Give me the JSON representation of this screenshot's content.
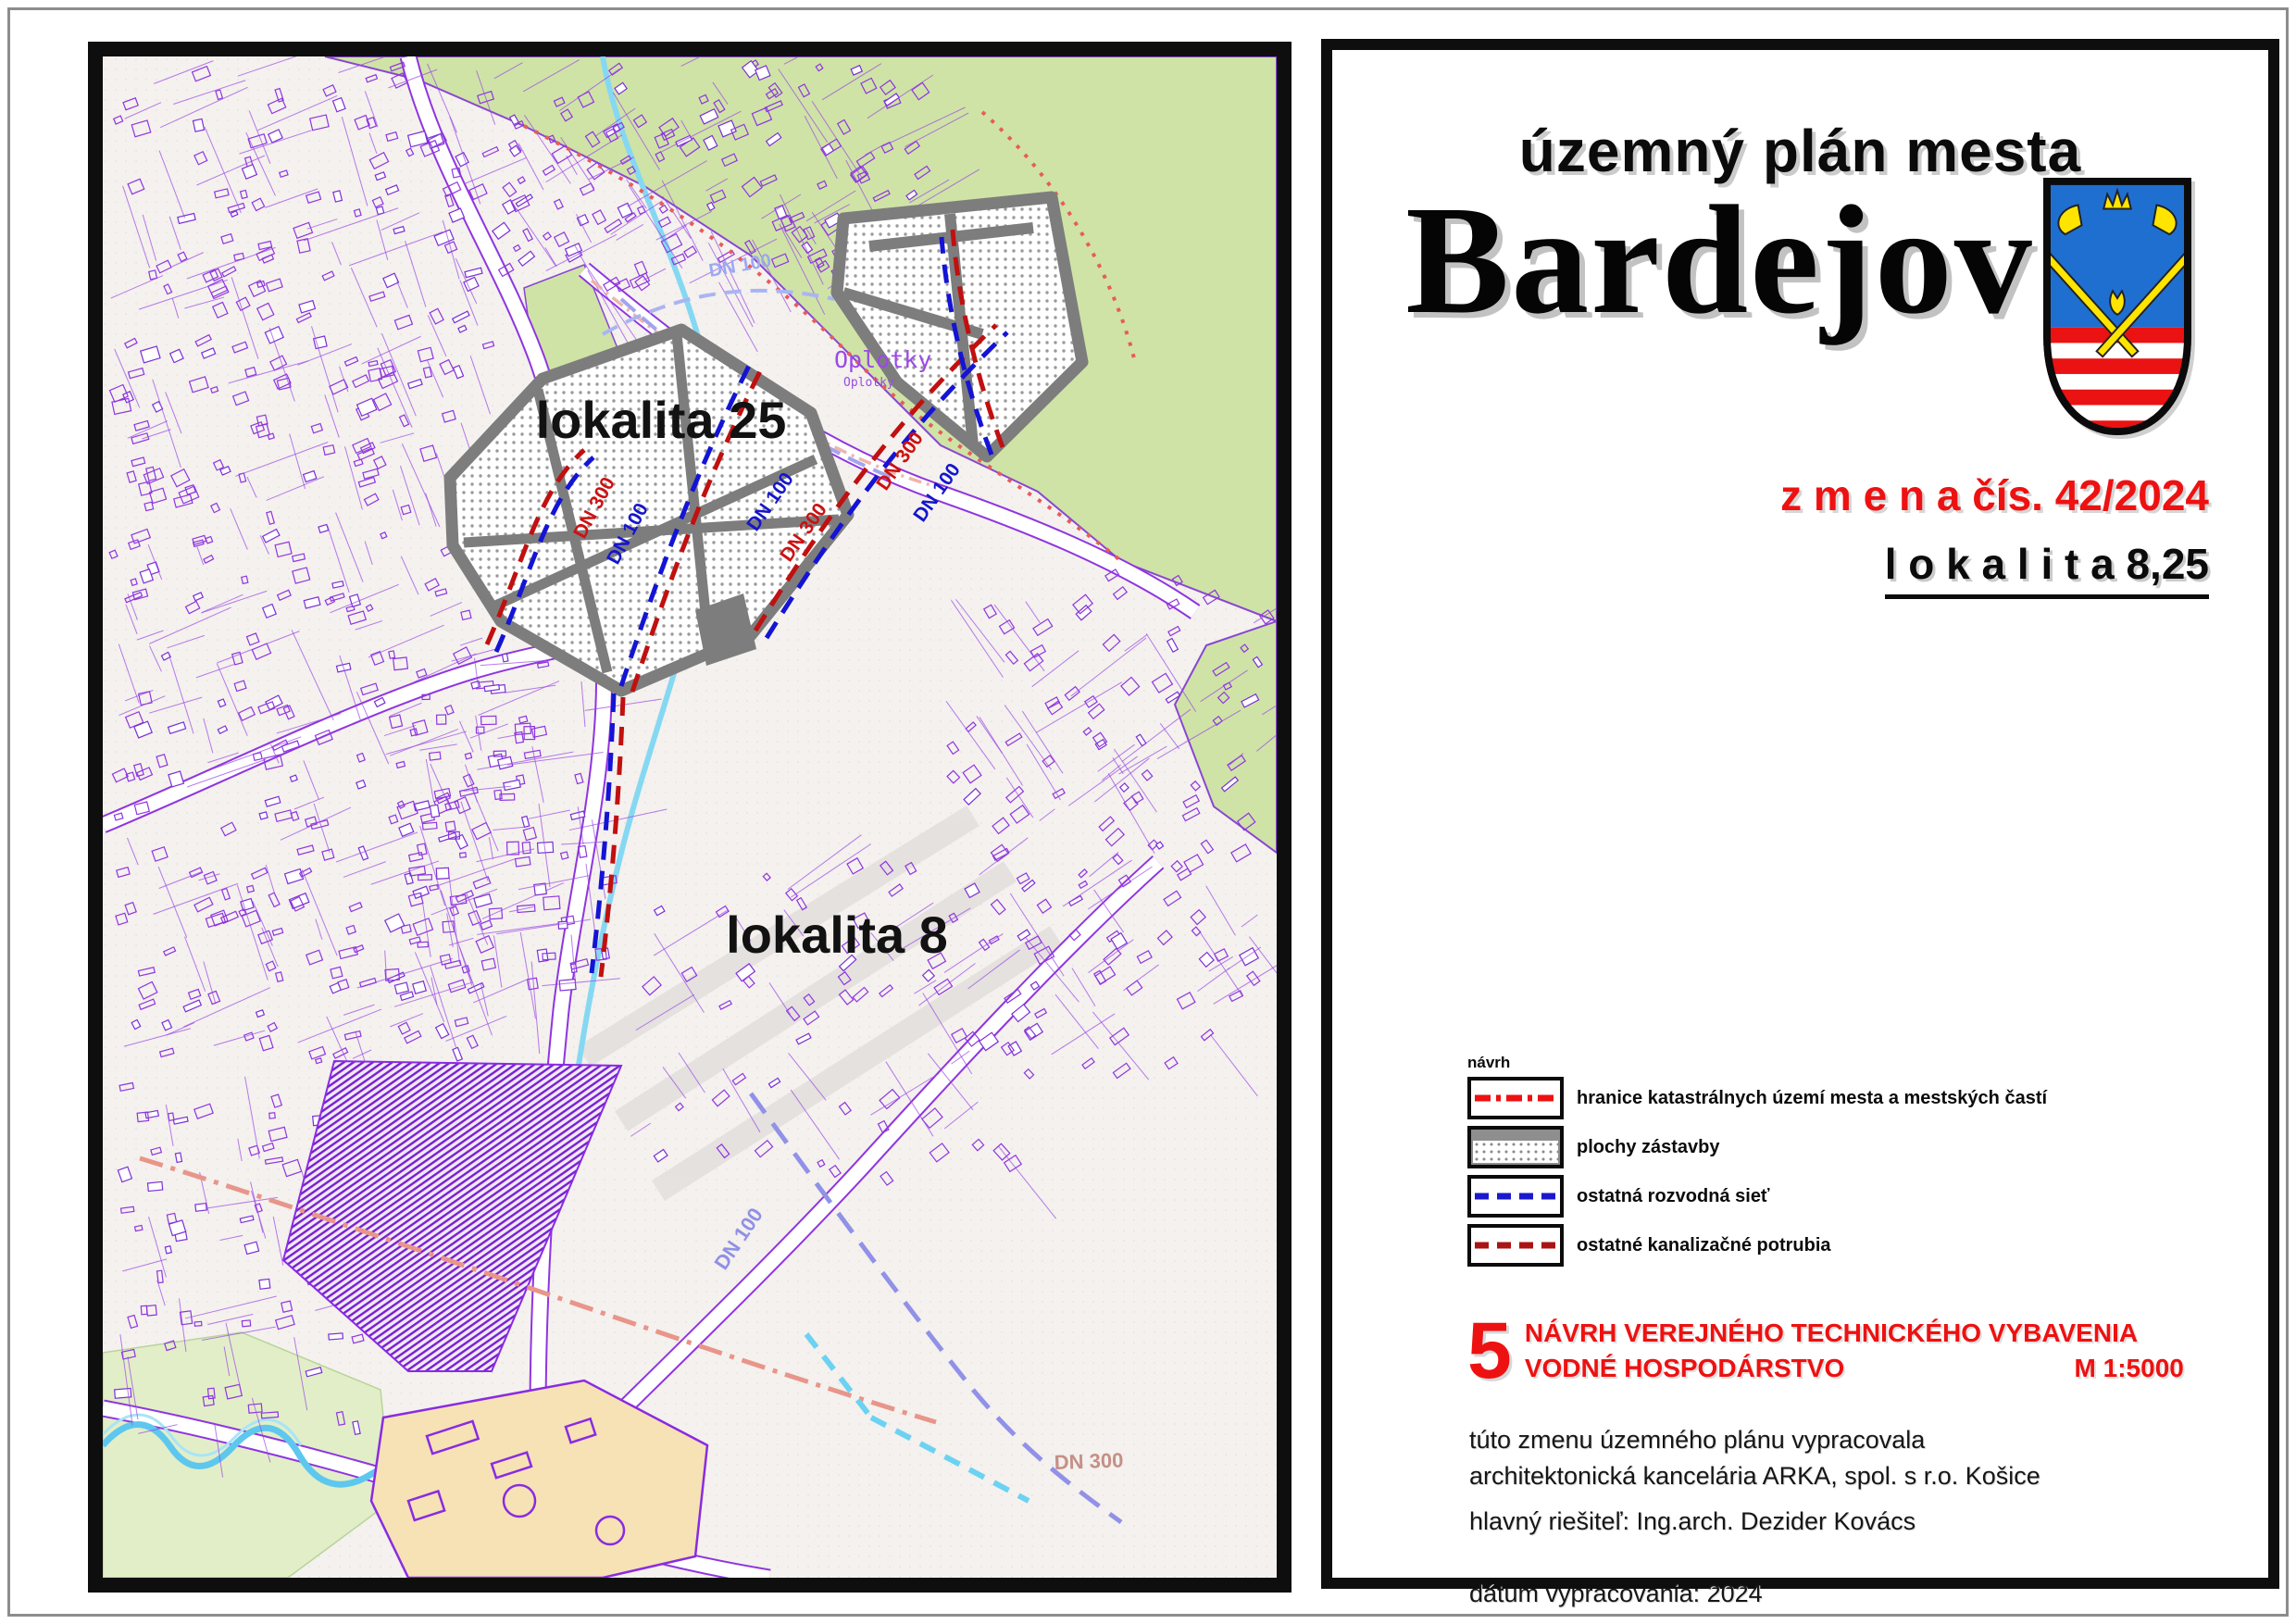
{
  "map_panel": {
    "labels": {
      "lokalita25": "lokalita 25",
      "lokalita8": "lokalita 8",
      "oplotky": "Oplotky",
      "dn100": "DN 100",
      "dn300": "DN 300"
    },
    "colors": {
      "forest_green": "#cfe3a6",
      "parcel_purple": "#8f35e0",
      "water_cyan": "#5ec7ee",
      "zone_gray": "#7d7d7d",
      "pipe_blue": "#1414d4",
      "pipe_red": "#c01010",
      "cov_tan": "#f6e2b4"
    }
  },
  "title_panel": {
    "title_small": "územný plán mesta",
    "title_city": "Bardejov",
    "change_line": "z m e n a  čís. 42/2024",
    "lokalita_line": "l o k a l i t a  8,25",
    "legend": {
      "heading": "návrh",
      "items": [
        {
          "label": "hranice katastrálnych území mesta a mestských častí",
          "type": "red-dashdot"
        },
        {
          "label": "plochy zástavby",
          "type": "zastavba-stipple"
        },
        {
          "label": "ostatná rozvodná sieť",
          "type": "blue-dash"
        },
        {
          "label": "ostatné kanalizačné potrubia",
          "type": "darkred-dash"
        }
      ]
    },
    "section": {
      "number": "5",
      "line1": "NÁVRH  VEREJNÉHO TECHNICKÉHO VYBAVENIA",
      "line2": "VODNÉ HOSPODÁRSTVO",
      "scale": "M 1:5000"
    },
    "credits": [
      "túto zmenu územného plánu vypracovala",
      "architektonická kancelária ARKA, spol. s r.o. Košice"
    ],
    "chief": "hlavný riešiteľ: Ing.arch. Dezider Kovács",
    "date": "dátum vypracovania: 2024"
  }
}
